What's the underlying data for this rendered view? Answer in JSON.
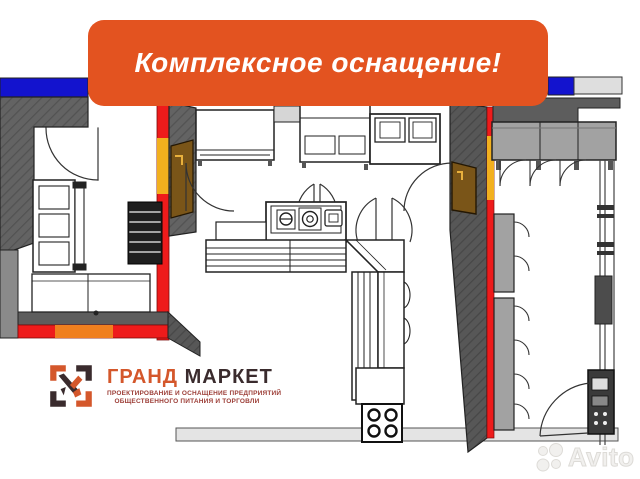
{
  "banner": {
    "label": "Комплексное оснащение!"
  },
  "logo": {
    "title_word1": "ГРАНД",
    "title_word2": "МАРКЕТ",
    "subtitle_line1": "ПРОЕКТИРОВАНИЕ И ОСНАЩЕНИЕ ПРЕДПРИЯТИЙ",
    "subtitle_line2": "ОБЩЕСТВЕННОГО ПИТАНИЯ И ТОРГОВЛИ",
    "icon": "grand-market-frame-check-icon"
  },
  "watermark": {
    "brand": "Avito",
    "icon": "avito-dots-icon"
  },
  "colors": {
    "banner_bg": "#E35320",
    "banner_text": "#FFFFFF",
    "logo_orange": "#D4572B",
    "logo_dark": "#3A2B2D",
    "subtitle_red": "#9C3D36",
    "wall_red": "#EE1B1B",
    "wall_yellow": "#F2B01E",
    "wall_orange": "#F07F1F",
    "wall_blue": "#1313CE",
    "wall_gray_dark": "#5D5D5D",
    "counter_gray": "#A2A2A2",
    "door_brown": "#7A5518",
    "floor_strip_gray": "#E4E4E4",
    "equipment_outline": "#222222"
  },
  "floor_plan": {
    "kind": "kitchen-equipment-layout-plan"
  }
}
